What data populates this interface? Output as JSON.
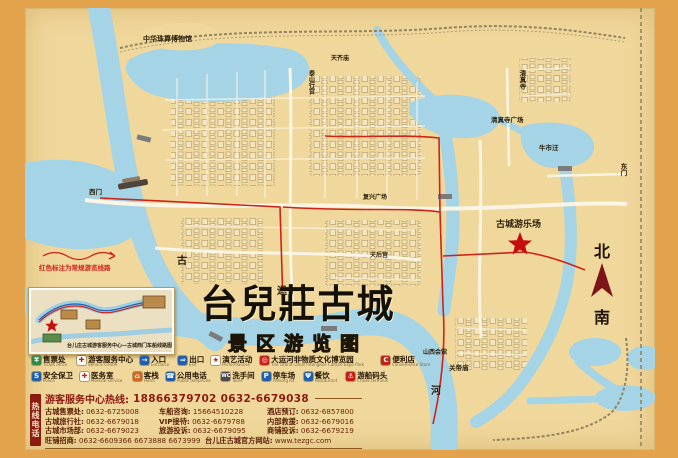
{
  "title": {
    "main": "台兒莊古城",
    "sub": "景区游览图"
  },
  "compass": {
    "north": "北",
    "south": "南"
  },
  "colors": {
    "water": "#a5d4e6",
    "land": "#f0d79b",
    "frame": "#e2a34c",
    "route_red": "#cf2318",
    "wall": "#9a8a6a",
    "hotline_red": "#8c1b12"
  },
  "map": {
    "notice": "红色标注为常规游览线路",
    "labels": [
      {
        "text": "中华珠算博物馆"
      },
      {
        "text": "天齐庙"
      },
      {
        "text": "泰山行宫"
      },
      {
        "text": "清真寺"
      },
      {
        "text": "清真寺广场"
      },
      {
        "text": "牛市汪"
      },
      {
        "text": "东门"
      },
      {
        "text": "古城游乐场"
      },
      {
        "text": "复兴广场"
      },
      {
        "text": "天后宫"
      },
      {
        "text": "山西会馆"
      },
      {
        "text": "关帝庙"
      },
      {
        "text": "西门"
      },
      {
        "text": "古"
      },
      {
        "text": "运"
      },
      {
        "text": "河"
      }
    ]
  },
  "inset": {
    "caption": "台儿庄古城游客服务中心—古城西门车船线路图"
  },
  "legend": {
    "row1": [
      {
        "label": "售票处",
        "en": "Ticket office",
        "glyph": "¥",
        "color": "#2e8b44"
      },
      {
        "label": "游客服务中心",
        "en": "Service Center",
        "glyph": "✚",
        "color": "#c71f16"
      },
      {
        "label": "入口",
        "en": "Entrance",
        "glyph": "→",
        "color": "#1f5fae"
      },
      {
        "label": "出口",
        "en": "Exit",
        "glyph": "⇒",
        "color": "#1f5fae"
      },
      {
        "label": "演艺活动",
        "en": "Performances",
        "glyph": "★",
        "color": "#c71f16"
      },
      {
        "label": "大运河非物质文化博览园",
        "en": "The Grand Canal Intangible Culture Expo Park",
        "glyph": "◎",
        "color": "#c71f16"
      },
      {
        "label": "便利店",
        "en": "Convenience Store",
        "glyph": "C",
        "color": "#c71f16"
      }
    ],
    "row2": [
      {
        "label": "安全保卫",
        "en": "Police",
        "glyph": "S",
        "color": "#1f5fae"
      },
      {
        "label": "医务室",
        "en": "Medical service",
        "glyph": "✚",
        "color": "#c71f16"
      },
      {
        "label": "客栈",
        "en": "Hotel",
        "glyph": "⌂",
        "color": "#d2691e"
      },
      {
        "label": "公用电话",
        "en": "Public telephone",
        "glyph": "☎",
        "color": "#1f5fae"
      },
      {
        "label": "洗手间",
        "en": "Toilet",
        "glyph": "WC",
        "color": "#4a4a52"
      },
      {
        "label": "停车场",
        "en": "Parking lot",
        "glyph": "P",
        "color": "#1f5fae"
      },
      {
        "label": "餐饮",
        "en": "Restaurant",
        "glyph": "Ψ",
        "color": "#1f5fae"
      },
      {
        "label": "游船码头",
        "en": "Cruise terminal",
        "glyph": "⚓",
        "color": "#c71f16"
      }
    ]
  },
  "hotline": {
    "side_tab": "热线电话",
    "head_label": "游客服务中心热线:",
    "head_numbers": "18866379702 0632-6679038",
    "grid": [
      {
        "label": "古城售票处:",
        "num": "0632-6725008"
      },
      {
        "label": "车船咨询:",
        "num": "15664510228"
      },
      {
        "label": "酒店预订:",
        "num": "0632-6857800"
      },
      {
        "label": "古城旅行社:",
        "num": "0632-6679018"
      },
      {
        "label": "VIP接待:",
        "num": "0632-6679788"
      },
      {
        "label": "内部救援:",
        "num": "0632-6679016"
      },
      {
        "label": "古城市场部:",
        "num": "0632-6679023"
      },
      {
        "label": "旅游投诉:",
        "num": "0632-6679095"
      },
      {
        "label": "商铺投诉:",
        "num": "0632-6679219"
      }
    ],
    "last": {
      "label": "旺铺招商:",
      "num": "0632-6609366 6673888 6673999",
      "site_label": "台儿庄古城官方网站:",
      "site": "www.tezgc.com"
    }
  }
}
